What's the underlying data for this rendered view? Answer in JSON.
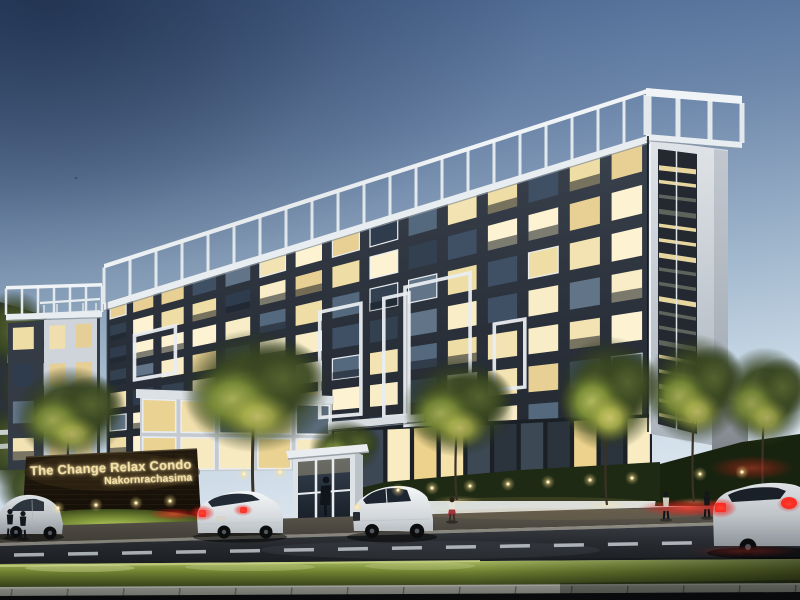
{
  "sign": {
    "title": "The Change Relax Condo",
    "subtitle": "Nakornrachasima"
  },
  "palette": {
    "sky_top": "#44608c",
    "sky_mid": "#9cb3ca",
    "sky_horizon": "#e2eaf1",
    "facade_dark": "#2a303a",
    "parapet_white": "#f0f4f6",
    "window_lit_shades": [
      "#f8edc6",
      "#efdda6",
      "#f3e3b2",
      "#e8d094",
      "#fdf3d3"
    ],
    "window_dark_shades": [
      "#3f4f64",
      "#2f3c4d",
      "#55697e",
      "#32404f",
      "#617488"
    ],
    "tower_white": "#d5dade",
    "louver_dark": "#232831",
    "louver_slit_lit": "#f2dfa4",
    "tree_dark": "#3b4922",
    "tree_lit": "#b9bf60",
    "hedge_green": "#1f2a15",
    "grass_lit": "#cfe57c",
    "road_asphalt": "#2c2f34",
    "lane_dash": "#cdd3d8",
    "sidewalk": "#5f5a50",
    "curb": "#b6b8ae",
    "sign_wall": "#1a130a",
    "sign_text_glow": "#f3e1a8",
    "taillight_red": "#ff3a2e",
    "car_white": "#f5f7f9",
    "car_silver": "#dfe3e6",
    "canopy_white": "#d8dde1",
    "booth_white": "#e9edf0",
    "guard_dark": "#10141b",
    "pillar_gray": "#9ba1a7",
    "glass_dark": "#1a2026"
  },
  "building": {
    "sections": [
      {
        "name": "left-wing",
        "x0": 8,
        "x1": 100,
        "top0": 323,
        "top1": 318,
        "bot0": 470,
        "bot1": 468,
        "floors": 4,
        "cols": 3,
        "ix": 0.16,
        "iy": 0.14,
        "iy2": 0.74,
        "lit": 0.5,
        "seed": 41,
        "wall": "#343b45",
        "balcony": true
      },
      {
        "name": "left-tower",
        "x0": 44,
        "x1": 97,
        "top0": 320,
        "top1": 317,
        "bot0": 472,
        "bot1": 470,
        "floors": 4,
        "cols": 2,
        "ix": 0.2,
        "iy": 0.16,
        "iy2": 0.78,
        "lit": 0.65,
        "seed": 31,
        "wall": "#ced4d9",
        "litShades": [
          "#f0dfae",
          "#e6cf96"
        ],
        "darkShades": [
          "#4a5866",
          "#5d6c7a"
        ]
      },
      {
        "name": "main-facade",
        "x0": 107,
        "x1": 648,
        "top0": 302,
        "top1": 136,
        "bot0": 458,
        "bot1": 432,
        "floors": 7,
        "cols": 15,
        "ix": 0.14,
        "iy": 0.12,
        "iy2": 0.8,
        "lit": 0.56,
        "seed": 1,
        "wall": "url(#gWall)",
        "balcony": true,
        "persp": 1.18,
        "frameP": 0.15
      },
      {
        "name": "clubhouse",
        "x0": 140,
        "x1": 332,
        "top0": 396,
        "top1": 403,
        "bot0": 472,
        "bot1": 470,
        "floors": 2,
        "cols": 5,
        "ix": 0.07,
        "iy": 0.08,
        "iy2": 0.94,
        "lit": 0.85,
        "seed": 21,
        "wall": "#c4cacf",
        "frameP": 1,
        "litShades": [
          "#f2e0ac",
          "#ead292",
          "#f7e9c0"
        ],
        "darkShades": [
          "#5b6b7a"
        ]
      },
      {
        "name": "ground-floor-glass",
        "x0": 332,
        "x1": 652,
        "top0": 428,
        "top1": 414,
        "bot0": 496,
        "bot1": 472,
        "floors": 1,
        "cols": 12,
        "ix": 0.08,
        "iy": 0.06,
        "iy2": 0.97,
        "lit": 0.78,
        "seed": 11,
        "wall": "#1a2026",
        "litShades": [
          "#f5e2a8",
          "#ecd28c",
          "#f9ecc2"
        ],
        "darkShades": [
          "#2b333d",
          "#3c4854"
        ]
      }
    ],
    "frames": [
      {
        "sec": "main-facade",
        "c0": 1.2,
        "c1": 2.6,
        "f0": 1.8,
        "f1": 3.7
      },
      {
        "sec": "main-facade",
        "c0": 6.8,
        "c1": 7.9,
        "f0": 2.5,
        "f1": 6.0
      },
      {
        "sec": "main-facade",
        "c0": 8.5,
        "c1": 9.15,
        "f0": 2.5,
        "f1": 6.15
      },
      {
        "sec": "main-facade",
        "c0": 9.05,
        "c1": 10.7,
        "f0": 2.3,
        "f1": 6.45
      },
      {
        "sec": "main-facade",
        "c0": 11.3,
        "c1": 12.05,
        "f0": 3.85,
        "f1": 5.65
      }
    ],
    "pergolas": [
      {
        "x0": 104,
        "y0": 264,
        "x1": 650,
        "y1": 88,
        "p0": 303,
        "p1": 135,
        "beamW": 4.5,
        "bandW": 7,
        "gap": 26,
        "postW": 3
      },
      {
        "x0": 6,
        "y0": 286,
        "x1": 102,
        "y1": 283,
        "p0": 314,
        "p1": 311,
        "beamW": 3.5,
        "bandW": 6,
        "gap": 15,
        "postW": 2.5
      },
      {
        "x0": 646,
        "y0": 88,
        "x1": 742,
        "y1": 96,
        "p0": 134,
        "p1": 142,
        "beamW": 8,
        "bandW": 6,
        "gap": 31,
        "postW": 5
      }
    ],
    "louvers": {
      "x0": 659,
      "x1": 696,
      "t0": 158,
      "t1": 162,
      "b0": 420,
      "b1": 428,
      "count": 18
    }
  },
  "landscape": {
    "trees": [
      {
        "cx": 70,
        "cy": 415,
        "rx": 56,
        "ry": 48,
        "gy": 505,
        "lit": 0.75
      },
      {
        "cx": 255,
        "cy": 392,
        "rx": 74,
        "ry": 62,
        "gy": 502,
        "lit": 0.85
      },
      {
        "cx": 345,
        "cy": 448,
        "rx": 36,
        "ry": 28,
        "gy": 500,
        "lit": 0.6
      },
      {
        "cx": 458,
        "cy": 408,
        "rx": 56,
        "ry": 50,
        "gy": 500,
        "lit": 0.8
      },
      {
        "cx": 608,
        "cy": 395,
        "rx": 52,
        "ry": 58,
        "gy": 505,
        "lit": 0.95
      },
      {
        "cx": 695,
        "cy": 390,
        "rx": 50,
        "ry": 55,
        "gy": 502,
        "lit": 0.8
      },
      {
        "cx": 765,
        "cy": 398,
        "rx": 46,
        "ry": 50,
        "gy": 500,
        "lit": 0.7
      }
    ],
    "uplights": [
      [
        58,
        508
      ],
      [
        96,
        505
      ],
      [
        136,
        503
      ],
      [
        170,
        501
      ],
      [
        244,
        474
      ],
      [
        280,
        472
      ],
      [
        398,
        490
      ],
      [
        432,
        488
      ],
      [
        470,
        486
      ],
      [
        508,
        484
      ],
      [
        548,
        482
      ],
      [
        590,
        480
      ],
      [
        632,
        478
      ],
      [
        700,
        474
      ],
      [
        742,
        472
      ]
    ],
    "curb_joints": 15
  },
  "people": [
    {
      "x": 10,
      "y": 537,
      "h": 28,
      "style": "dark"
    },
    {
      "x": 23,
      "y": 538,
      "h": 27,
      "style": "dark"
    },
    {
      "x": 452,
      "y": 521,
      "h": 24,
      "style": "red-skirt"
    },
    {
      "x": 666,
      "y": 519,
      "h": 27,
      "style": "light-top"
    },
    {
      "x": 707,
      "y": 517,
      "h": 26,
      "style": "dark"
    }
  ],
  "road": {
    "dash_pattern": "30 24"
  }
}
